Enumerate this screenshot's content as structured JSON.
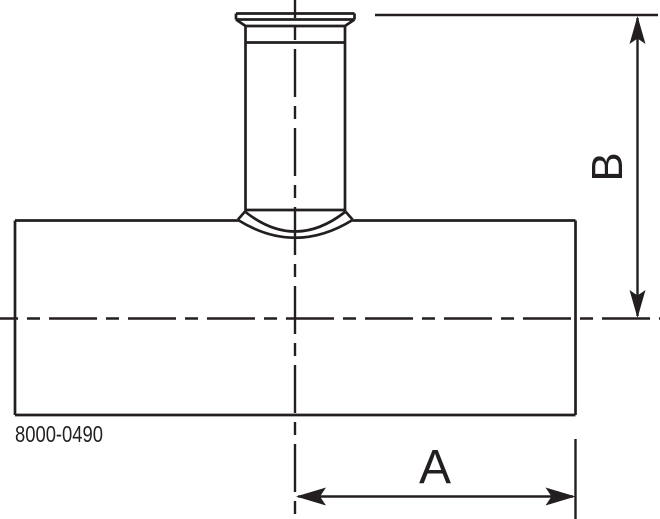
{
  "drawing": {
    "type_note": "technical line drawing of a reducing tee with clamp-ferrule branch",
    "part_number": "8000-0490",
    "labels": {
      "a": "A",
      "b": "B"
    },
    "icons": {
      "dimension_arrow": "barbed-arrowhead"
    },
    "colors": {
      "line": "#231f20",
      "background": "#ffffff"
    }
  }
}
